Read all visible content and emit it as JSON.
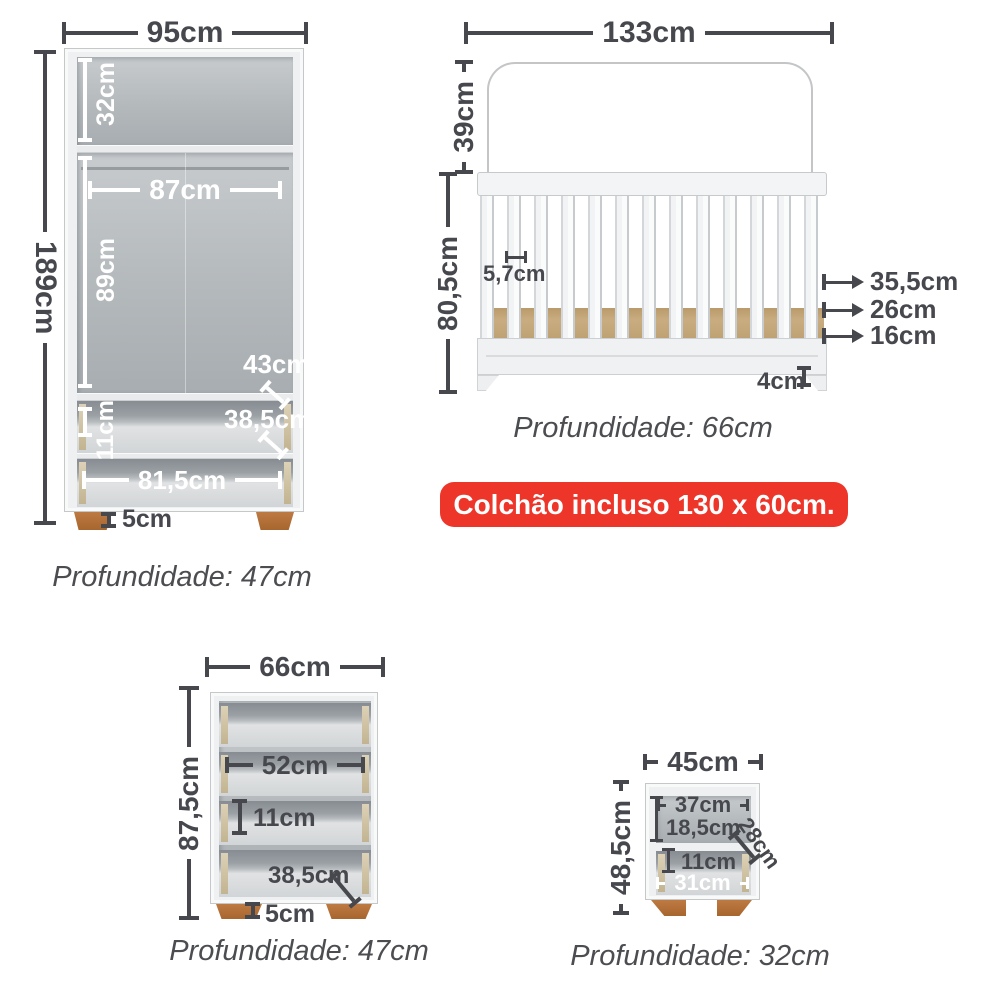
{
  "colors": {
    "dimension_text": "#46484e",
    "depth_text": "#4c4d51",
    "badge_background": "#ee352a",
    "badge_text": "#ffffff",
    "wood_feet": "#b37138",
    "mattress_base_wood": "#c9ad80",
    "furniture_gray": "#eef0f1"
  },
  "wardrobe": {
    "width": "95cm",
    "height": "189cm",
    "top_shelf_height": "32cm",
    "inner_width": "87cm",
    "inner_height": "89cm",
    "top_drawer_depth": "43cm",
    "drawer_depth": "38,5cm",
    "drawer_height": "11cm",
    "drawer_width": "81,5cm",
    "feet_height": "5cm",
    "depth": "Profundidade: 47cm"
  },
  "crib": {
    "width": "133cm",
    "headboard_height": "39cm",
    "rail_height": "80,5cm",
    "slat_gap": "5,7cm",
    "mattress_heights": [
      "35,5cm",
      "26cm",
      "16cm"
    ],
    "base_height": "4cm",
    "depth": "Profundidade: 66cm",
    "badge": "Colchão incluso 130 x 60cm."
  },
  "dresser": {
    "width": "66cm",
    "height": "87,5cm",
    "drawer_width": "52cm",
    "drawer_height": "11cm",
    "drawer_depth": "38,5cm",
    "feet_height": "5cm",
    "depth": "Profundidade: 47cm"
  },
  "nightstand": {
    "width": "45cm",
    "height": "48,5cm",
    "niche_width": "37cm",
    "niche_height": "18,5cm",
    "niche_depth": "28cm",
    "drawer_height": "11cm",
    "drawer_width": "31cm",
    "depth": "Profundidade: 32cm"
  }
}
